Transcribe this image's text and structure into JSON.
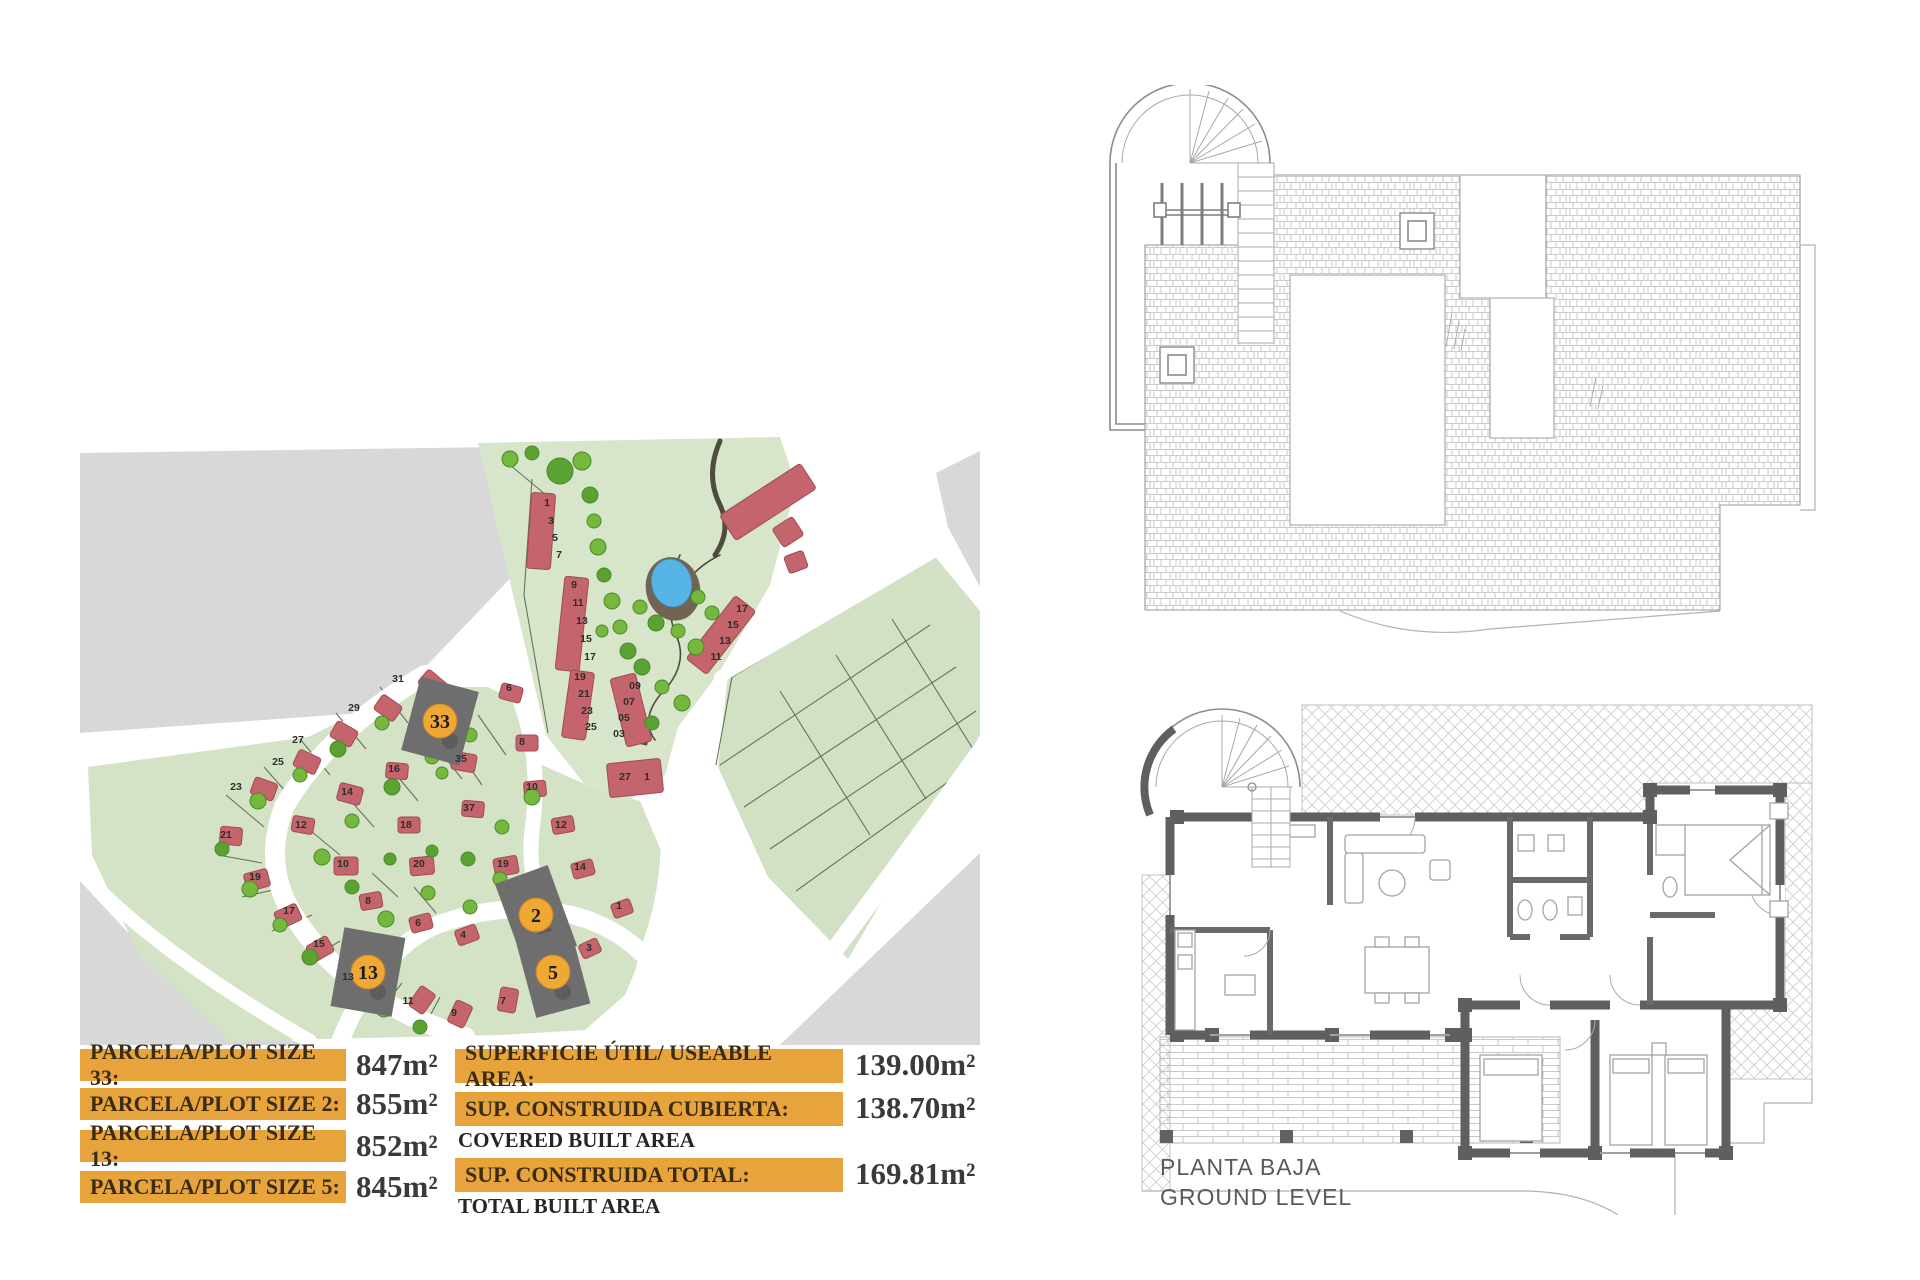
{
  "page": {
    "background": "#ffffff"
  },
  "legend": {
    "colors": {
      "bar": "#e7a43c",
      "bar_text": "#3b2b12",
      "value_text": "#3a3a3a"
    },
    "plot_sizes": [
      {
        "label": "PARCELA/PLOT SIZE 33:",
        "value": "847m²"
      },
      {
        "label": "PARCELA/PLOT SIZE 2:",
        "value": "855m²"
      },
      {
        "label": "PARCELA/PLOT SIZE 13:",
        "value": "852m²"
      },
      {
        "label": "PARCELA/PLOT SIZE 5:",
        "value": "845m²"
      }
    ],
    "areas": [
      {
        "label": "SUPERFICIE ÚTIL/ USEABLE AREA:",
        "sublabel": "",
        "value": "139.00m²"
      },
      {
        "label": "SUP. CONSTRUIDA CUBIERTA:",
        "sublabel": "COVERED BUILT AREA",
        "value": "138.70m²"
      },
      {
        "label": "SUP. CONSTRUIDA TOTAL:",
        "sublabel": "TOTAL BUILT AREA",
        "value": "169.81m²"
      }
    ]
  },
  "ground_plan": {
    "caption_line1": "PLANTA BAJA",
    "caption_line2": "GROUND LEVEL"
  },
  "site_plan": {
    "colors": {
      "road_gray": "#d8d8d8",
      "green_fan": "#d4e2c6",
      "green_north": "#d7e5ca",
      "green_grid": "#d2e0c4",
      "house": "#c4646c",
      "house_edge": "#a14b53",
      "highlight": "#6e6e6e",
      "orange": "#f0a835",
      "orange_edge": "#c5832a",
      "tree": "#74b93d",
      "tree_dark": "#5aa332",
      "tree_edge": "#4a8a28",
      "line": "#63745a",
      "path_dark": "#4d4d3e",
      "pond_mud": "#716452",
      "pond_water": "#57b5e6",
      "number": "#2e2e2e"
    },
    "gray_areas": [
      "0,18 558,10 330,248 282,278 0,298",
      "0,446 108,562 228,612 0,612",
      "856,38 900,16 900,152 868,92",
      "700,610 900,418 900,610"
    ],
    "green_areas": [
      {
        "points": "8,332 228,302 330,252 408,252 444,270 462,330 520,356 560,366 585,425 570,500 545,560 505,595 420,600 150,606 58,518 12,420",
        "fill": "green_fan"
      },
      {
        "points": "398,8 700,2 716,50 690,150 640,236 598,292 585,340 545,368 505,350 466,300 444,206 420,104",
        "fill": "green_north"
      },
      {
        "points": "648,240 852,118 900,176 900,300 768,524 688,442 638,332",
        "fill": "green_grid"
      }
    ],
    "roads": [
      {
        "d": "M345,240 Q250,295 205,370 Q185,420 205,465 Q230,515 285,555 Q330,585 385,602",
        "w": 20
      },
      {
        "d": "M258,612 Q292,522 352,492 Q422,464 492,480 Q532,490 562,518",
        "w": 18
      },
      {
        "d": "M440,265 Q462,325 452,395 Q446,445 472,502",
        "w": 15
      },
      {
        "d": "M585,352 Q597,430 572,505 Q556,550 562,592",
        "w": 16
      },
      {
        "d": "M0,436 Q80,520 230,606",
        "w": 14
      },
      {
        "d": "M640,242 L862,112",
        "w": 12
      },
      {
        "d": "M905,310 Q790,470 690,600",
        "w": 18
      }
    ],
    "parcel_lines": [
      "M300,252 L328,288",
      "M256,278 L286,314",
      "M220,304 L250,340",
      "M184,332 L214,366",
      "M146,360 L184,392",
      "M138,420 L182,428",
      "M162,462 L206,452",
      "M192,496 L232,480",
      "M224,528 L260,506",
      "M258,556 L290,530",
      "M298,578 L322,548",
      "M342,596 L360,562",
      "M398,280 L426,320",
      "M352,306 L382,344",
      "M308,330 L338,366",
      "M262,356 L294,392",
      "M226,392 L260,420",
      "M292,438 L318,462",
      "M334,452 L356,478",
      "M374,310 L402,350",
      "M452,44 L444,160",
      "M444,160 L468,298",
      "M466,60 L430,30",
      "M636,330 L652,242 L854,120",
      "M640,330 L850,190",
      "M664,372 L876,232",
      "M690,414 L896,276",
      "M716,456 L900,324",
      "M700,256 L790,400",
      "M756,220 L846,364",
      "M812,184 L898,322"
    ],
    "dark_paths": [
      {
        "d": "M640,6 Q625,40 640,70 Q652,95 635,120",
        "w": 5
      },
      {
        "d": "M600,120 Q580,160 596,200 Q610,230 580,260 Q560,285 575,305",
        "w": 1.6
      },
      {
        "d": "M640,120 Q600,140 596,176",
        "w": 1.6
      }
    ],
    "dark_squares": [
      {
        "x": 552,
        "y": 292,
        "s": 17,
        "rot": 12
      }
    ],
    "pond": {
      "cx": 592,
      "cy": 150,
      "mud_rx": 27,
      "mud_ry": 32,
      "water_rx": 20,
      "water_ry": 24
    },
    "strips": [
      {
        "x": 449,
        "y": 58,
        "w": 24,
        "h": 76,
        "rot": 4
      },
      {
        "x": 480,
        "y": 142,
        "w": 24,
        "h": 94,
        "rot": 6
      },
      {
        "x": 628,
        "y": 160,
        "w": 26,
        "h": 80,
        "rot": 38
      },
      {
        "x": 486,
        "y": 236,
        "w": 24,
        "h": 68,
        "rot": 8
      },
      {
        "x": 538,
        "y": 240,
        "w": 26,
        "h": 70,
        "rot": -14
      },
      {
        "x": 528,
        "y": 326,
        "w": 54,
        "h": 34,
        "rot": -6
      },
      {
        "x": 640,
        "y": 52,
        "w": 96,
        "h": 30,
        "rot": -33
      },
      {
        "x": 696,
        "y": 86,
        "w": 24,
        "h": 22,
        "rot": -33
      },
      {
        "x": 706,
        "y": 118,
        "w": 20,
        "h": 18,
        "rot": -20
      }
    ],
    "houses": [
      {
        "x": 340,
        "y": 240,
        "w": 26,
        "h": 18,
        "rot": 40
      },
      {
        "x": 296,
        "y": 264,
        "w": 24,
        "h": 18,
        "rot": 35
      },
      {
        "x": 252,
        "y": 290,
        "w": 24,
        "h": 18,
        "rot": 30
      },
      {
        "x": 215,
        "y": 318,
        "w": 24,
        "h": 18,
        "rot": 25
      },
      {
        "x": 172,
        "y": 345,
        "w": 24,
        "h": 18,
        "rot": 20
      },
      {
        "x": 140,
        "y": 392,
        "w": 22,
        "h": 18,
        "rot": 5
      },
      {
        "x": 165,
        "y": 436,
        "w": 24,
        "h": 18,
        "rot": -15
      },
      {
        "x": 196,
        "y": 472,
        "w": 24,
        "h": 18,
        "rot": -25
      },
      {
        "x": 228,
        "y": 505,
        "w": 24,
        "h": 18,
        "rot": -30
      },
      {
        "x": 262,
        "y": 534,
        "w": 24,
        "h": 18,
        "rot": -35
      },
      {
        "x": 330,
        "y": 556,
        "w": 24,
        "h": 18,
        "rot": -55
      },
      {
        "x": 368,
        "y": 570,
        "w": 24,
        "h": 18,
        "rot": -65
      },
      {
        "x": 416,
        "y": 556,
        "w": 24,
        "h": 18,
        "rot": -80
      },
      {
        "x": 420,
        "y": 250,
        "w": 22,
        "h": 16,
        "rot": 15
      },
      {
        "x": 436,
        "y": 300,
        "w": 22,
        "h": 16,
        "rot": 0
      },
      {
        "x": 372,
        "y": 318,
        "w": 24,
        "h": 18,
        "rot": 10
      },
      {
        "x": 306,
        "y": 328,
        "w": 22,
        "h": 16,
        "rot": 5
      },
      {
        "x": 258,
        "y": 350,
        "w": 24,
        "h": 18,
        "rot": 15
      },
      {
        "x": 212,
        "y": 382,
        "w": 22,
        "h": 16,
        "rot": 10
      },
      {
        "x": 318,
        "y": 382,
        "w": 22,
        "h": 16,
        "rot": 0
      },
      {
        "x": 254,
        "y": 422,
        "w": 24,
        "h": 18,
        "rot": 0
      },
      {
        "x": 330,
        "y": 422,
        "w": 24,
        "h": 18,
        "rot": -5
      },
      {
        "x": 280,
        "y": 458,
        "w": 22,
        "h": 16,
        "rot": -10
      },
      {
        "x": 330,
        "y": 480,
        "w": 22,
        "h": 16,
        "rot": -15
      },
      {
        "x": 376,
        "y": 492,
        "w": 22,
        "h": 16,
        "rot": -20
      },
      {
        "x": 382,
        "y": 366,
        "w": 22,
        "h": 16,
        "rot": 5
      },
      {
        "x": 444,
        "y": 346,
        "w": 22,
        "h": 16,
        "rot": -5
      },
      {
        "x": 472,
        "y": 382,
        "w": 22,
        "h": 16,
        "rot": -10
      },
      {
        "x": 414,
        "y": 422,
        "w": 24,
        "h": 18,
        "rot": -10
      },
      {
        "x": 492,
        "y": 426,
        "w": 22,
        "h": 16,
        "rot": -15
      },
      {
        "x": 532,
        "y": 466,
        "w": 20,
        "h": 15,
        "rot": -20
      },
      {
        "x": 500,
        "y": 506,
        "w": 20,
        "h": 15,
        "rot": -25
      }
    ],
    "trees": [
      {
        "x": 510,
        "y": 60,
        "r": 8
      },
      {
        "x": 514,
        "y": 86,
        "r": 7
      },
      {
        "x": 518,
        "y": 112,
        "r": 8
      },
      {
        "x": 524,
        "y": 140,
        "r": 7
      },
      {
        "x": 532,
        "y": 166,
        "r": 8
      },
      {
        "x": 540,
        "y": 192,
        "r": 7
      },
      {
        "x": 548,
        "y": 216,
        "r": 8
      },
      {
        "x": 522,
        "y": 196,
        "r": 6
      },
      {
        "x": 560,
        "y": 172,
        "r": 7
      },
      {
        "x": 576,
        "y": 188,
        "r": 8
      },
      {
        "x": 598,
        "y": 196,
        "r": 7
      },
      {
        "x": 616,
        "y": 212,
        "r": 8
      },
      {
        "x": 562,
        "y": 232,
        "r": 8
      },
      {
        "x": 582,
        "y": 252,
        "r": 7
      },
      {
        "x": 602,
        "y": 268,
        "r": 8
      },
      {
        "x": 572,
        "y": 288,
        "r": 7
      },
      {
        "x": 618,
        "y": 162,
        "r": 7
      },
      {
        "x": 632,
        "y": 178,
        "r": 7
      },
      {
        "x": 480,
        "y": 36,
        "r": 13
      },
      {
        "x": 502,
        "y": 26,
        "r": 9
      },
      {
        "x": 430,
        "y": 24,
        "r": 8
      },
      {
        "x": 452,
        "y": 18,
        "r": 7
      },
      {
        "x": 346,
        "y": 262,
        "r": 8
      },
      {
        "x": 302,
        "y": 288,
        "r": 7
      },
      {
        "x": 258,
        "y": 314,
        "r": 8
      },
      {
        "x": 220,
        "y": 340,
        "r": 7
      },
      {
        "x": 178,
        "y": 366,
        "r": 8
      },
      {
        "x": 142,
        "y": 414,
        "r": 7
      },
      {
        "x": 170,
        "y": 454,
        "r": 8
      },
      {
        "x": 200,
        "y": 490,
        "r": 7
      },
      {
        "x": 230,
        "y": 522,
        "r": 8
      },
      {
        "x": 264,
        "y": 550,
        "r": 7
      },
      {
        "x": 304,
        "y": 574,
        "r": 8
      },
      {
        "x": 340,
        "y": 592,
        "r": 7
      },
      {
        "x": 390,
        "y": 300,
        "r": 7
      },
      {
        "x": 352,
        "y": 322,
        "r": 7
      },
      {
        "x": 312,
        "y": 352,
        "r": 8
      },
      {
        "x": 272,
        "y": 386,
        "r": 7
      },
      {
        "x": 242,
        "y": 422,
        "r": 8
      },
      {
        "x": 272,
        "y": 452,
        "r": 7
      },
      {
        "x": 306,
        "y": 484,
        "r": 8
      },
      {
        "x": 348,
        "y": 458,
        "r": 7
      },
      {
        "x": 388,
        "y": 424,
        "r": 7
      },
      {
        "x": 422,
        "y": 392,
        "r": 7
      },
      {
        "x": 452,
        "y": 362,
        "r": 8
      },
      {
        "x": 352,
        "y": 416,
        "r": 6
      },
      {
        "x": 390,
        "y": 472,
        "r": 7
      },
      {
        "x": 420,
        "y": 444,
        "r": 7
      },
      {
        "x": 310,
        "y": 424,
        "r": 6
      },
      {
        "x": 362,
        "y": 338,
        "r": 6
      }
    ],
    "plot_numbers": [
      {
        "n": "31",
        "x": 318,
        "y": 247
      },
      {
        "n": "29",
        "x": 274,
        "y": 276
      },
      {
        "n": "27",
        "x": 218,
        "y": 308
      },
      {
        "n": "25",
        "x": 198,
        "y": 330
      },
      {
        "n": "23",
        "x": 156,
        "y": 355
      },
      {
        "n": "21",
        "x": 146,
        "y": 403
      },
      {
        "n": "19",
        "x": 175,
        "y": 445
      },
      {
        "n": "17",
        "x": 209,
        "y": 479
      },
      {
        "n": "15",
        "x": 239,
        "y": 512
      },
      {
        "n": "13",
        "x": 268,
        "y": 545
      },
      {
        "n": "11",
        "x": 328,
        "y": 569
      },
      {
        "n": "9",
        "x": 374,
        "y": 581
      },
      {
        "n": "7",
        "x": 423,
        "y": 569
      },
      {
        "n": "6",
        "x": 429,
        "y": 256
      },
      {
        "n": "8",
        "x": 442,
        "y": 310
      },
      {
        "n": "35",
        "x": 381,
        "y": 327
      },
      {
        "n": "16",
        "x": 314,
        "y": 337
      },
      {
        "n": "14",
        "x": 267,
        "y": 360
      },
      {
        "n": "12",
        "x": 221,
        "y": 393
      },
      {
        "n": "18",
        "x": 326,
        "y": 393
      },
      {
        "n": "10",
        "x": 263,
        "y": 432
      },
      {
        "n": "20",
        "x": 339,
        "y": 432
      },
      {
        "n": "8",
        "x": 288,
        "y": 469
      },
      {
        "n": "6",
        "x": 338,
        "y": 491
      },
      {
        "n": "4",
        "x": 383,
        "y": 503
      },
      {
        "n": "37",
        "x": 389,
        "y": 376
      },
      {
        "n": "10",
        "x": 452,
        "y": 355
      },
      {
        "n": "12",
        "x": 481,
        "y": 393
      },
      {
        "n": "19",
        "x": 423,
        "y": 432
      },
      {
        "n": "14",
        "x": 500,
        "y": 435
      },
      {
        "n": "1",
        "x": 539,
        "y": 474
      },
      {
        "n": "3",
        "x": 509,
        "y": 516
      },
      {
        "n": "1",
        "x": 467,
        "y": 71
      },
      {
        "n": "3",
        "x": 471,
        "y": 89
      },
      {
        "n": "5",
        "x": 475,
        "y": 106
      },
      {
        "n": "7",
        "x": 479,
        "y": 123
      },
      {
        "n": "9",
        "x": 494,
        "y": 153
      },
      {
        "n": "11",
        "x": 498,
        "y": 171
      },
      {
        "n": "13",
        "x": 502,
        "y": 189
      },
      {
        "n": "15",
        "x": 506,
        "y": 207
      },
      {
        "n": "17",
        "x": 510,
        "y": 225
      },
      {
        "n": "17",
        "x": 662,
        "y": 177
      },
      {
        "n": "15",
        "x": 653,
        "y": 193
      },
      {
        "n": "13",
        "x": 645,
        "y": 209
      },
      {
        "n": "11",
        "x": 636,
        "y": 225
      },
      {
        "n": "19",
        "x": 500,
        "y": 245
      },
      {
        "n": "21",
        "x": 504,
        "y": 262
      },
      {
        "n": "23",
        "x": 507,
        "y": 279
      },
      {
        "n": "25",
        "x": 511,
        "y": 295
      },
      {
        "n": "09",
        "x": 555,
        "y": 254
      },
      {
        "n": "07",
        "x": 549,
        "y": 270
      },
      {
        "n": "05",
        "x": 544,
        "y": 286
      },
      {
        "n": "03",
        "x": 539,
        "y": 302
      },
      {
        "n": "27",
        "x": 545,
        "y": 345
      },
      {
        "n": "1",
        "x": 567,
        "y": 345
      }
    ],
    "highlights": [
      {
        "n": "33",
        "x": 360,
        "y": 286,
        "w": 60,
        "h": 76,
        "rot": 15
      },
      {
        "n": "2",
        "x": 456,
        "y": 480,
        "w": 56,
        "h": 86,
        "rot": -20
      },
      {
        "n": "13",
        "x": 288,
        "y": 537,
        "w": 62,
        "h": 80,
        "rot": 10
      },
      {
        "n": "5",
        "x": 473,
        "y": 537,
        "w": 56,
        "h": 80,
        "rot": -15
      }
    ]
  }
}
